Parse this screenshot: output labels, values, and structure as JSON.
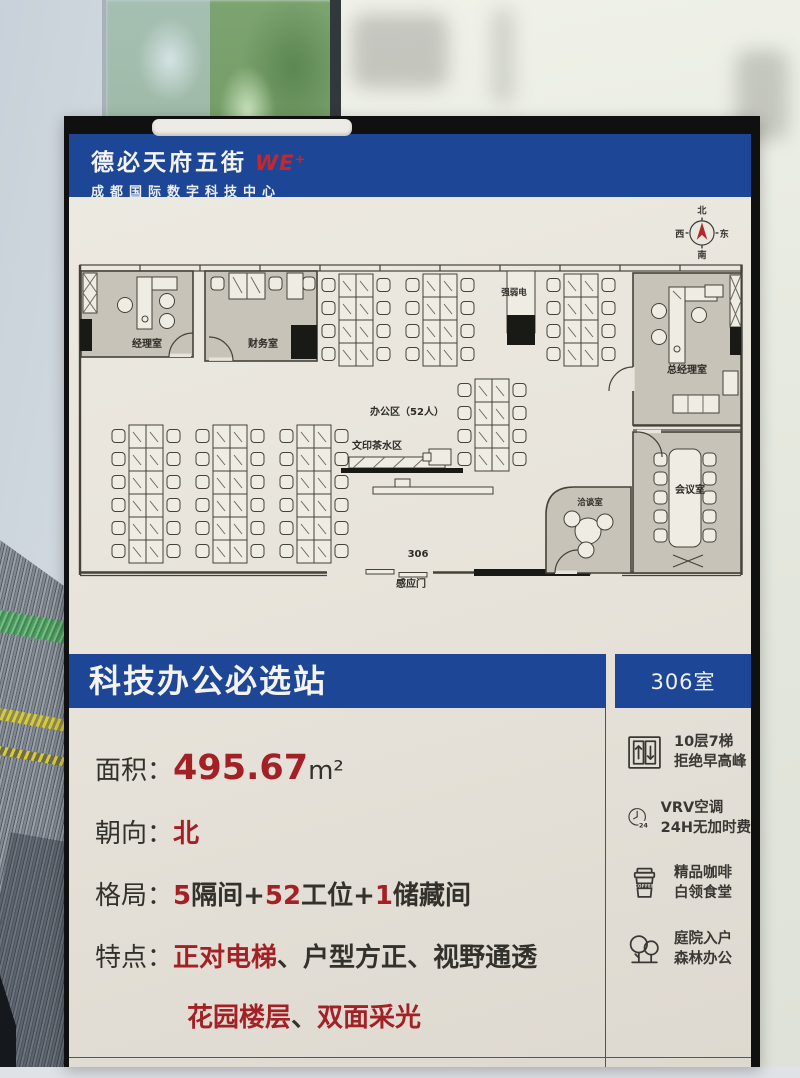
{
  "header": {
    "brand": "德必天府五街",
    "brand_mark": "WE⁺",
    "subtitle": "成都国际数字科技中心"
  },
  "compass": {
    "n": "北",
    "e": "东",
    "s": "南",
    "w": "西"
  },
  "floorplan": {
    "rooms": {
      "manager": "经理室",
      "finance": "财务室",
      "electrical": "强弱电",
      "general_manager": "总经理室",
      "meeting": "会议室",
      "negotiation": "洽谈室"
    },
    "labels": {
      "office_area": "办公区（52人）",
      "print_tea": "文印茶水区",
      "room_number": "306",
      "sensor_door": "感应门"
    }
  },
  "banner": {
    "title": "科技办公必选站",
    "room": "306室"
  },
  "details": {
    "area": {
      "label": "面积：",
      "value": "495.67",
      "unit": "m²"
    },
    "orientation": {
      "label": "朝向：",
      "value": "北"
    },
    "layout": {
      "label": "格局：",
      "n1": "5",
      "t1": "隔间",
      "p1": "+",
      "n2": "52",
      "t2": "工位",
      "p2": "+",
      "n3": "1",
      "t3": "储藏间"
    },
    "features": {
      "label": "特点：",
      "f1": "正对电梯",
      "sep1": "、",
      "f2": "户型方正",
      "sep2": "、",
      "f3": "视野通透",
      "f4": "花园楼层",
      "sep3": "、",
      "f5": "双面采光"
    }
  },
  "amenities": [
    {
      "icon": "elevator-icon",
      "line1": "10层7梯",
      "line2": "拒绝早高峰"
    },
    {
      "icon": "clock-24h-icon",
      "badge": "24",
      "line1": "VRV空调",
      "line2": "24H无加时费"
    },
    {
      "icon": "coffee-icon",
      "badge": "COFFEE",
      "line1": "精品咖啡",
      "line2": "白领食堂"
    },
    {
      "icon": "trees-icon",
      "line1": "庭院入户",
      "line2": "森林办公"
    }
  ],
  "colors": {
    "brand_blue": "#1d4796",
    "accent_red": "#a32125",
    "poster_cream": "#e8e4db"
  }
}
